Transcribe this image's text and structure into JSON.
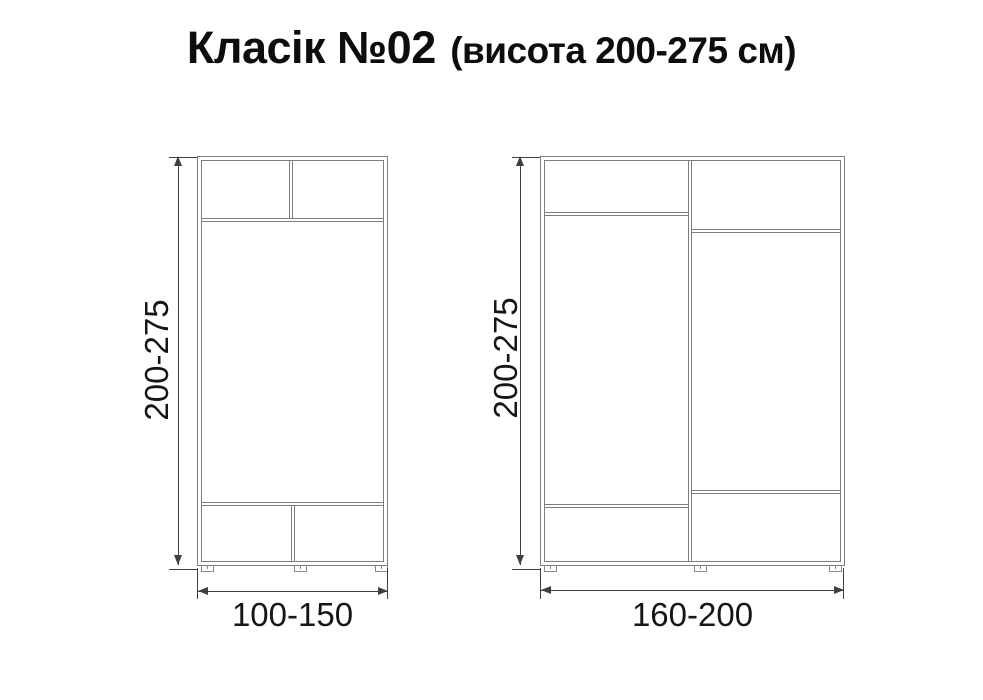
{
  "title": {
    "main": "Класік №02",
    "sub": "(висота 200-275 см)"
  },
  "wardrobes": {
    "small": {
      "height_label": "200-275",
      "width_label": "100-150"
    },
    "large": {
      "height_label": "200-275",
      "width_label": "160-200"
    }
  },
  "colors": {
    "background": "#ffffff",
    "furniture_line": "#7d7d7d",
    "dimension_line": "#3f3f3f",
    "label_text": "#161616",
    "title_text": "#0d0d0d"
  }
}
